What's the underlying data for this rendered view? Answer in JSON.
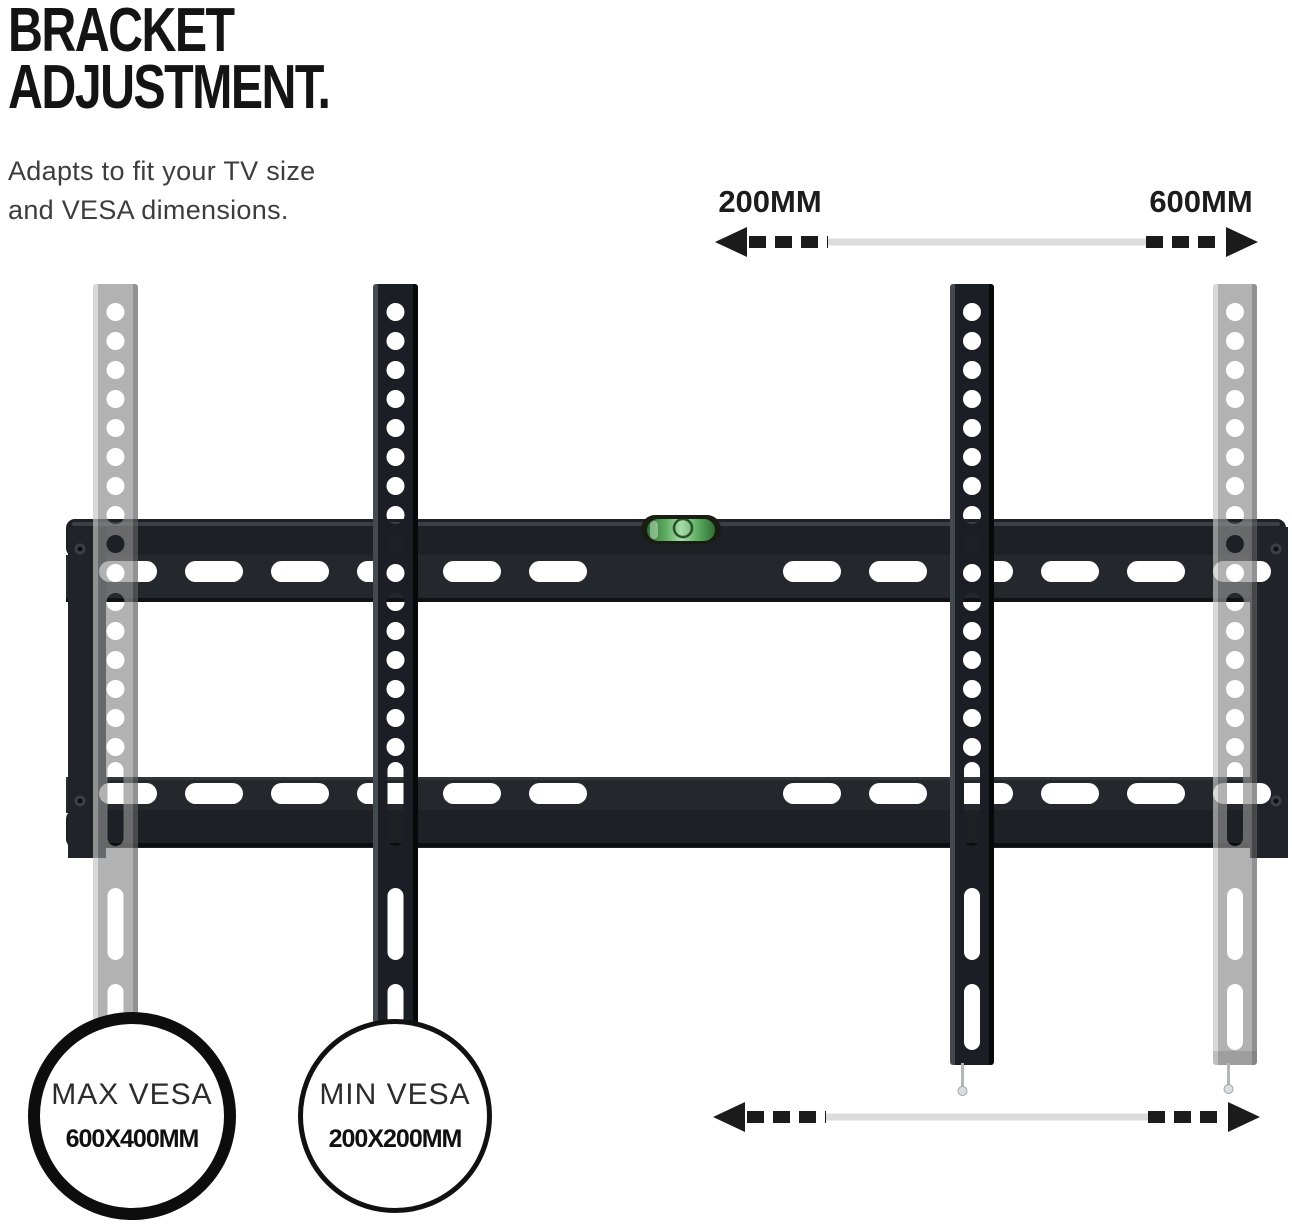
{
  "title": {
    "line1": "BRACKET",
    "line2": "ADJUSTMENT."
  },
  "subtitle": {
    "line1": "Adapts to fit your TV size",
    "line2": "and VESA dimensions."
  },
  "top_dimension": {
    "left_label": "200MM",
    "right_label": "600MM"
  },
  "badges": {
    "max_vesa": {
      "title": "MAX VESA",
      "value": "600X400MM"
    },
    "min_vesa": {
      "title": "MIN VESA",
      "value": "200X200MM"
    }
  },
  "icons": {
    "top_arrow": "double-headed-dashed-arrow",
    "bottom_arrow": "double-headed-dashed-arrow",
    "spirit_level": "bubble-level",
    "ghost_arms": "adjustable-bracket-ghost-position",
    "pins": "locking-pin"
  },
  "colors": {
    "background": "#ffffff",
    "text_black": "#141414",
    "plate_black": "#23262b",
    "ghost_gray": "#b5b5b5",
    "level_green": "#7ac97a",
    "arrow_black": "#1b1b1b",
    "arrow_gray": "#dcdcdc"
  }
}
